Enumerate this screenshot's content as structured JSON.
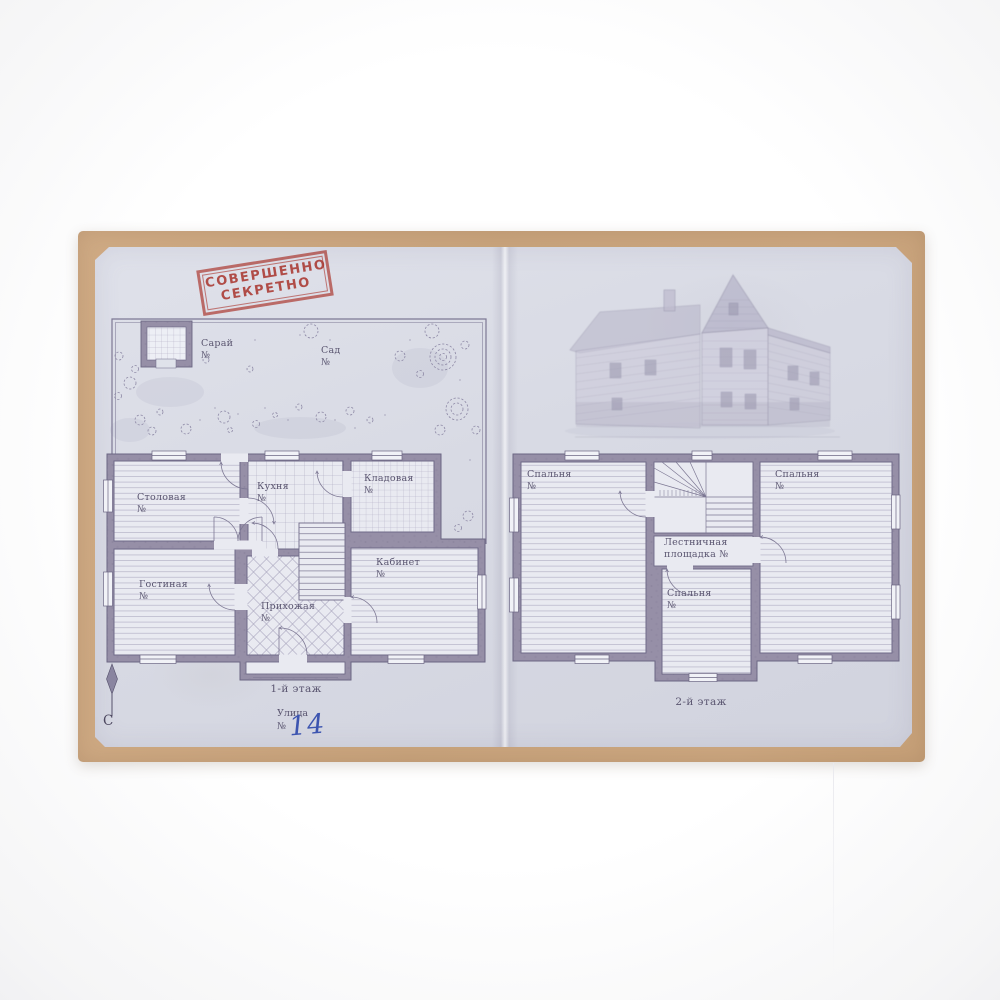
{
  "page": {
    "stamp": {
      "line1": "СОВЕРШЕННО",
      "line2": "СЕКРЕТНО"
    },
    "site": {
      "shed": {
        "name": "Сарай",
        "num": "№"
      },
      "garden": {
        "name": "Сад",
        "num": "№"
      }
    },
    "floor1": {
      "caption": "1-й этаж",
      "rooms": {
        "dining": {
          "name": "Столовая",
          "num": "№"
        },
        "kitchen": {
          "name": "Кухня",
          "num": "№"
        },
        "pantry": {
          "name": "Кладовая",
          "num": "№"
        },
        "living": {
          "name": "Гостиная",
          "num": "№"
        },
        "hallway": {
          "name": "Прихожая",
          "num": "№"
        },
        "study": {
          "name": "Кабинет",
          "num": "№"
        }
      }
    },
    "floor2": {
      "caption": "2-й этаж",
      "rooms": {
        "bedroom_left": {
          "name": "Спальня",
          "num": "№"
        },
        "bedroom_right": {
          "name": "Спальня",
          "num": "№"
        },
        "bedroom_middle": {
          "name": "Спальня",
          "num": "№"
        },
        "stair_landing": {
          "line1": "Лестничная",
          "line2": "площадка №"
        }
      }
    },
    "street": {
      "label": "Улица",
      "num_sign": "№",
      "house_number": "14"
    },
    "compass": {
      "north_label": "С"
    }
  },
  "colors": {
    "folder_kraft": "#c9a47d",
    "paper_blue_grey": "#d8dae4",
    "stamp_red": "#c5453c",
    "ink_blue": "#3d55b0",
    "plan_line": "#6f6a88",
    "wall_fill": "#968fa7",
    "label_text": "#5a5570"
  }
}
